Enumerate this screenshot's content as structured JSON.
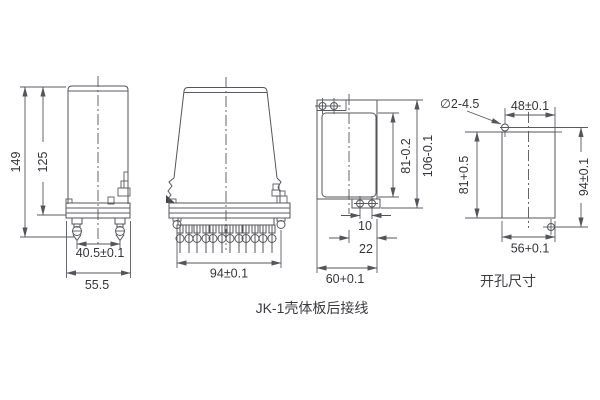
{
  "captions": {
    "main": "JK-1壳体板后接线",
    "cutout": "开孔尺寸"
  },
  "views": {
    "side": {
      "dims": {
        "total_height": "149",
        "case_height": "125",
        "stud_spacing": "40.5±0.1",
        "overall_width": "55.5"
      }
    },
    "front": {
      "dims": {
        "mounting_width": "94±0.1"
      }
    },
    "plate": {
      "dims": {
        "cutout_height": "81-0.2",
        "overall_height": "106-0.1",
        "hole_pitch": "10",
        "flange_width": "22",
        "overall_width": "60+0.1"
      }
    },
    "cutout": {
      "dims": {
        "hole_note": "∅2-4.5",
        "hole_span_horizontal": "48±0.1",
        "opening_height": "81+0.5",
        "hole_span_vertical": "94±0.1",
        "opening_width": "56+0.1"
      }
    }
  }
}
